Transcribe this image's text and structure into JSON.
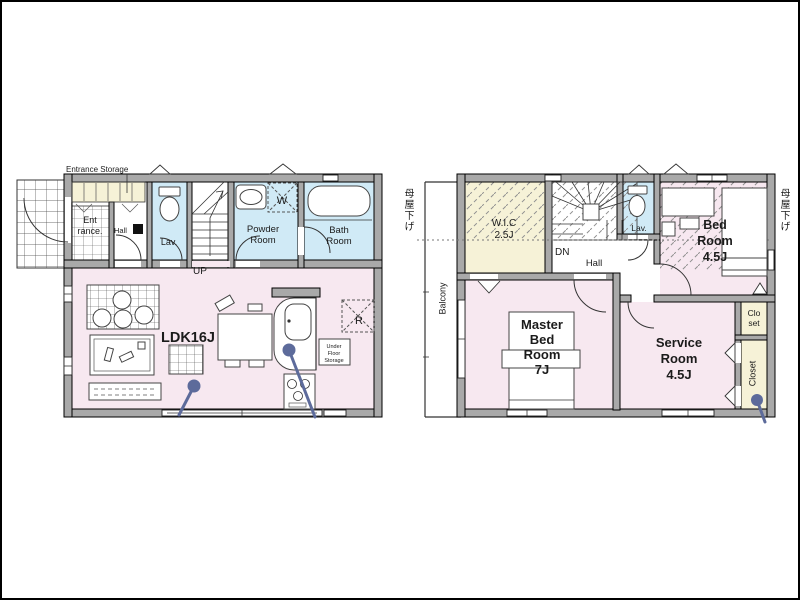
{
  "colors": {
    "room_pink": "#f7e8f0",
    "wet_blue": "#d0eaf6",
    "storage_yellow": "#f6f2d7",
    "wall_gray": "#a9a9a9",
    "hatch_gray": "#909090",
    "pin_blue": "#5d6b9b",
    "line_dark": "#1b1b1b",
    "page_border": "#000000"
  },
  "floor1": {
    "labels": {
      "entrance_storage": "Entrance Storage",
      "entrance": [
        "Ent",
        "rance."
      ],
      "hall": "Hall",
      "lav": "Lav.",
      "up": "UP",
      "powder_room": [
        "Powder",
        "Room"
      ],
      "washer": "W",
      "bath_room": [
        "Bath",
        "Room"
      ],
      "ldk": "LDK16J",
      "refrigerator": "R",
      "under_floor_storage": [
        "Under",
        "Floor",
        "Storage"
      ]
    }
  },
  "floor2": {
    "labels": {
      "roof_lowered_left": "母屋下げ",
      "roof_lowered_right": "母屋下げ",
      "balcony": "Balcony",
      "wic": [
        "W.I.C",
        "2.5J"
      ],
      "dn": "DN",
      "hall": "Hall",
      "lav": "Lav.",
      "bed_room": [
        "Bed",
        "Room",
        "4.5J"
      ],
      "master_bed_room": [
        "Master",
        "Bed",
        "Room",
        "7J"
      ],
      "service_room": [
        "Service",
        "Room",
        "4.5J"
      ],
      "closet_upper": [
        "Clo",
        "set"
      ],
      "closet_lower": "Closet"
    }
  }
}
